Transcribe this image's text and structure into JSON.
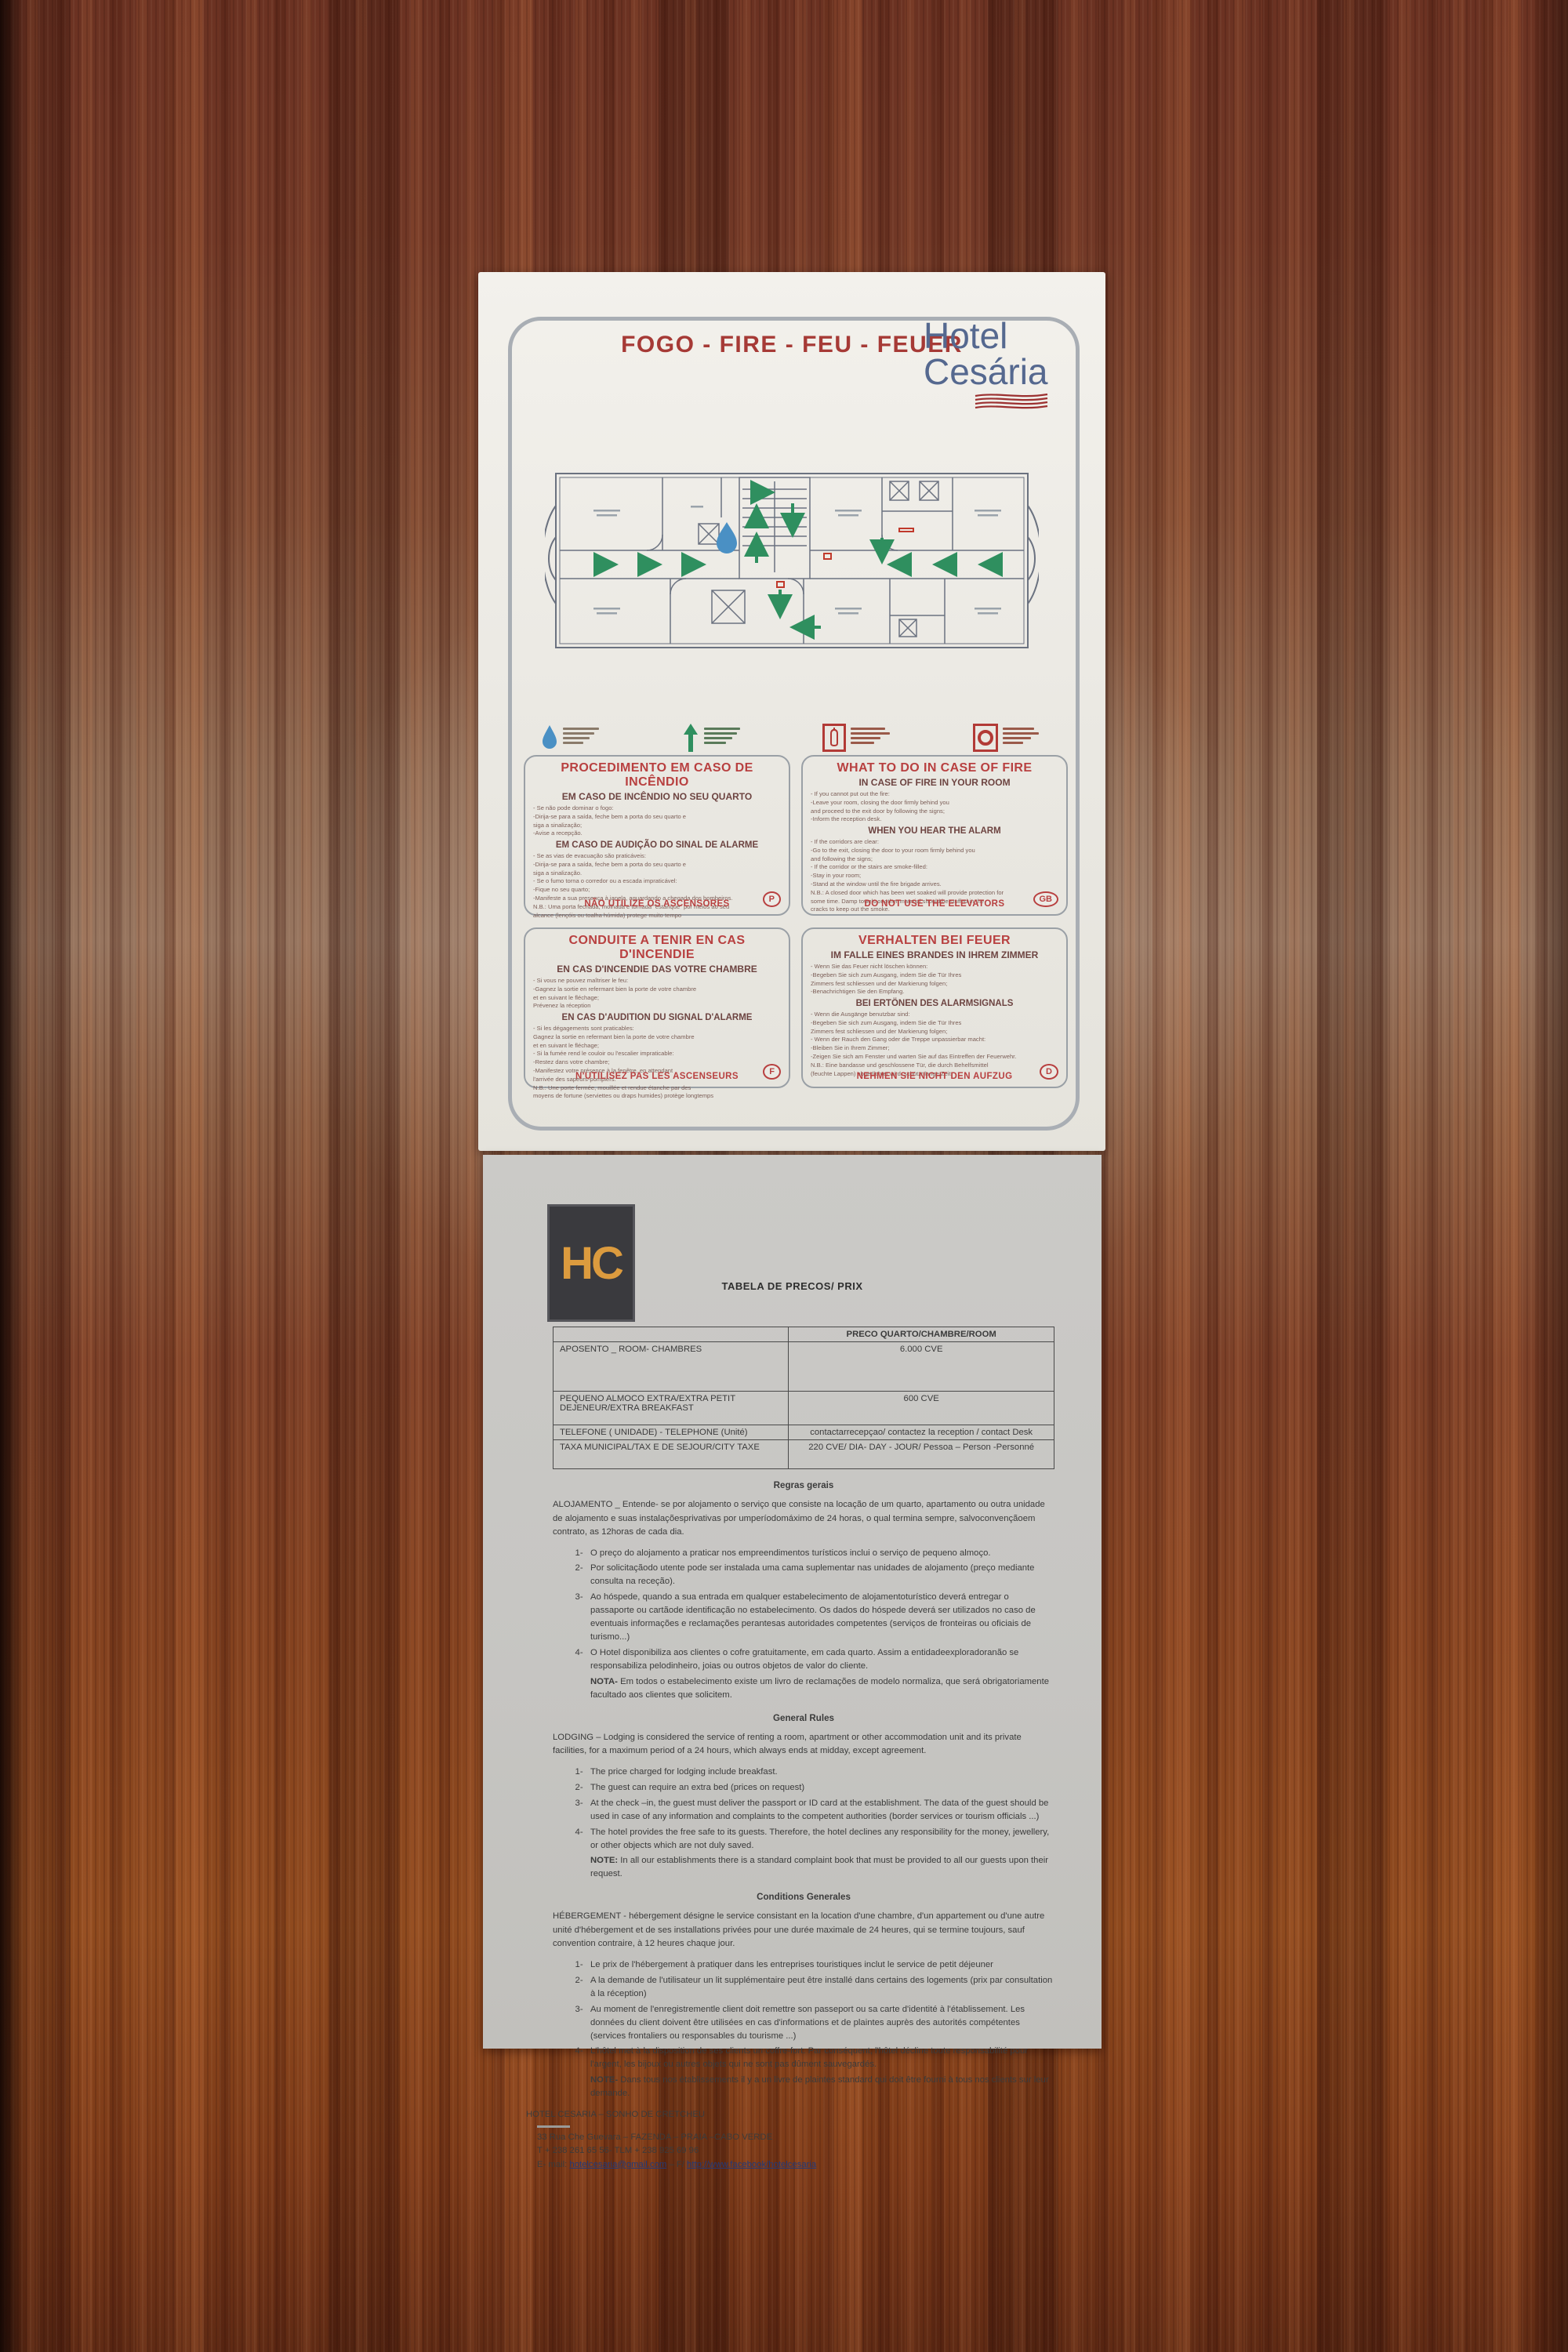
{
  "colors": {
    "wood_base": "#7b3f27",
    "sheet_white": "#f0eee9",
    "sheet_gray": "#c7c6c3",
    "title_red": "#a63a36",
    "notice_red": "#b84040",
    "subtitle_maroon": "#6d4441",
    "brand_blue": "#55688f",
    "wave_red": "#9c3030",
    "arrow_green": "#2f8f5f",
    "droplet_blue": "#4a90c4",
    "hc_orange": "#dc9b3e",
    "link_blue": "#223a7a"
  },
  "fire_notice": {
    "title": "FOGO - FIRE - FEU - FEUER",
    "brand": {
      "line1": "Hotel",
      "line2": "Cesária"
    },
    "legend_icons": [
      "you-are-here-droplet",
      "evacuation-route-arrow",
      "fire-extinguisher",
      "fire-hose-reel"
    ],
    "boxes": {
      "pt": {
        "title": "PROCEDIMENTO EM CASO DE INCÊNDIO",
        "subtitle": "EM CASO DE INCÊNDIO NO SEU QUARTO",
        "part1": [
          "- Se não pode dominar o fogo:",
          "-Dirija-se para a saída, feche  bem a porta do seu quarto  e",
          "siga a sinalização;",
          "-Avise a recepção."
        ],
        "heading2": "EM CASO DE AUDIÇÃO DO SINAL DE ALARME",
        "part2": [
          "- Se as vias de evacuação são praticáveis:",
          "-Dirija-se para a saída, feche  bem a porta do seu quarto  e",
          "siga a sinalização.",
          "- Se o fumo torna o corredor ou a escada impraticável:",
          "-Fique no seu quarto;",
          "-Manifeste a sua presença à janela, aguardando a chegada dos bombeiros.",
          "N.B.: Uma porta fechada, molhada e tornada \"estanque\" por meios ao seu",
          "alcance (lençóis ou toalha húmida) protege muito tempo"
        ],
        "warning": "NÃO UTILIZE OS ASCENSORES",
        "badge": "P"
      },
      "gb": {
        "title": "WHAT TO DO IN CASE OF FIRE",
        "subtitle": "IN CASE OF FIRE IN YOUR ROOM",
        "part1": [
          "- If you cannot put out the fire:",
          "-Leave your room, closing the door firmly behind you",
          "and proceed to the exit door by following the signs;",
          "-Inform the reception desk."
        ],
        "heading2": "WHEN YOU HEAR THE ALARM",
        "part2": [
          "- If the corridors are clear:",
          "-Go to the exit, closing the door to your room firmly behind you",
          "and following the signs;",
          "- If the corridor or the stairs are smoke-filled:",
          "-Stay in your room;",
          "-Stand at the window until the fire brigade arrives.",
          "N.B.: A closed door which has been wet soaked will provide protection for",
          "some time. Damp towels or other material should be stuffed in the",
          "cracks to keep out the smoke."
        ],
        "warning": "DO NOT USE THE ELEVATORS",
        "badge": "GB"
      },
      "fr": {
        "title": "CONDUITE A TENIR EN CAS D'INCENDIE",
        "subtitle": "EN CAS D'INCENDIE DAS VOTRE CHAMBRE",
        "part1": [
          "- Si vous ne pouvez maîtriser le feu:",
          "-Gagnez la sortie en refermant bien la porte de votre chambre",
          "et en suivant le fléchage;",
          "Prévenez la réception"
        ],
        "heading2": "EN CAS D'AUDITION DU SIGNAL D'ALARME",
        "part2": [
          "- Si les dégagements sont praticables:",
          "Gagnez la sortie en refermant bien la porte de votre chambre",
          "et en suivant le fléchage;",
          "- Si la fumée rend le couloir ou l'escalier impraticable:",
          "-Restez dans votre chambre;",
          "-Manifestez votre présence à la fenêtre, en attendant",
          "l'arrivée des sapeurs-pompiers.",
          "N.B.: Une porte fermée, mouillée et rendue étanche par des",
          "moyens de fortune (serviettes ou draps humides) protège longtemps"
        ],
        "warning": "N'UTILISEZ PAS LES ASCENSEURS",
        "badge": "F"
      },
      "de": {
        "title": "VERHALTEN BEI FEUER",
        "subtitle": "IM FALLE EINES BRANDES IN IHREM ZIMMER",
        "part1": [
          "- Wenn Sie das Feuer nicht löschen können:",
          "-Begeben Sie sich zum Ausgang, indem Sie die Tür Ihres",
          "Zimmers fest schliessen und der Markierung folgen;",
          "-Benachrichtigen Sie den Empfang."
        ],
        "heading2": "BEI ERTÖNEN DES ALARMSIGNALS",
        "part2": [
          "- Wenn die Ausgänge benutzbar sind:",
          "-Begeben Sie sich zum Ausgang, indem Sie die Tür Ihres",
          "Zimmers fest schliessen und der Markierung folgen;",
          "- Wenn der Rauch den Gang oder die Treppe unpassierbar macht:",
          "-Bleiben Sie in Ihrem Zimmer;",
          "-Zeigen Sie sich am Fenster und warten Sie auf das Eintreffen der Feuerwehr.",
          "N.B.: Eine bandasse und geschlossene Tür, die durch Behelfsmittel",
          "(feuchte Lappen) abgedichtet wird, schützt lange Zeit."
        ],
        "warning": "NEHMEN SIE NICHT DEN AUFZUG",
        "badge": "D"
      }
    }
  },
  "price_sheet": {
    "logo": "HC",
    "title": "TABELA DE PRECOS/ PRIX",
    "table": {
      "header_right": "PRECO QUARTO/CHAMBRE/ROOM",
      "rows": [
        {
          "label": "APOSENTO _ ROOM- CHAMBRES",
          "value": "6.000 CVE"
        },
        {
          "label": "PEQUENO ALMOCO EXTRA/EXTRA PETIT DEJENEUR/EXTRA BREAKFAST",
          "value": "600 CVE"
        },
        {
          "label": "TELEFONE ( UNIDADE) - TELEPHONE (Unité)",
          "value": "contactarrecepçao/ contactez la reception / contact Desk"
        },
        {
          "label": "TAXA MUNICIPAL/TAX E DE SEJOUR/CITY TAXE",
          "value": "220 CVE/ DIA- DAY - JOUR/ Pessoa – Person -Personné"
        }
      ]
    },
    "rules_pt": {
      "heading": "Regras gerais",
      "intro": "ALOJAMENTO _ Entende- se por alojamento o serviço que consiste na locação de um quarto, apartamento ou outra unidade de alojamento e suas instalaçõesprivativas por umperíodomáximo de 24 horas, o qual termina sempre, salvoconvençãoem contrato, as 12horas de cada dia.",
      "items": [
        "O preço do alojamento a praticar nos empreendimentos turísticos inclui o serviço de pequeno almoço.",
        "Por solicitaçãodo utente pode ser instalada uma cama suplementar nas unidades de alojamento (preço mediante consulta na receção).",
        "Ao hóspede, quando a sua entrada em qualquer estabelecimento de alojamentoturístico deverá entregar o passaporte ou cartãode identificação no estabelecimento. Os dados do hóspede deverá ser utilizados no caso de eventuais informações e reclamações perantesas autoridades competentes (serviços de fronteiras ou oficiais de turismo...)",
        "O Hotel disponibiliza aos clientes o cofre gratuitamente, em cada quarto. Assim a entidadeexploradoranão se responsabiliza pelodinheiro, joias ou outros objetos de valor do cliente."
      ],
      "note_label": "NOTA-",
      "note": " Em todos o estabelecimento existe um livro de reclamações de modelo normaliza, que será obrigatoriamente facultado aos clientes que solicitem."
    },
    "rules_en": {
      "heading": "General Rules",
      "intro": "LODGING – Lodging is considered the service of renting a room, apartment or other accommodation unit and its private facilities, for a maximum period of a 24 hours, which always ends at midday, except agreement.",
      "items": [
        "The price charged for lodging include breakfast.",
        "The guest can require an extra bed (prices on request)",
        "At the check –in, the guest must deliver the passport or ID card at the establishment. The data of the guest should be used in case of any information and complaints to the competent authorities (border services or tourism officials ...)",
        "The hotel provides the free safe to its guests. Therefore, the hotel declines any responsibility for the money, jewellery, or other objects which are not duly saved."
      ],
      "note_label": "NOTE:",
      "note": " In all our establishments there is a standard complaint book that must be provided to all our guests upon their request."
    },
    "rules_fr": {
      "heading": "Conditions Generales",
      "intro": "HÉBERGEMENT - hébergement désigne le service consistant en la location d'une chambre, d'un appartement ou d'une autre unité d'hébergement et de ses installations privées pour une durée maximale de 24 heures, qui se termine toujours, sauf convention contraire, à 12 heures chaque jour.",
      "items": [
        "Le prix de l'hébergement à pratiquer dans les entreprises touristiques inclut le service de petit déjeuner",
        "A la demande de l'utilisateur un lit supplémentaire peut être installé dans certains des logements (prix par consultation à la réception)",
        "Au moment de l'enregistrementle client doit remettre son passeport ou sa carte d'identité à l'établissement. Les données du client doivent être utilisées en cas d'informations et de plaintes auprès des autorités compétentes (services frontaliers ou responsables du tourisme ...)",
        "L'hôtel met à la disposition de ses clients un coffre-fort. Par conséquent, l'hôtel décline toute responsabilité pour l'argent, les bijoux ou autres objets qui ne sont pas dûment sauvegardés."
      ],
      "note_label": "NOTE-",
      "note": " Dans tous nos établissements il y a un livre de plaintes standard qui doit être fourni à tous nos clients sur leur demande."
    },
    "footer": {
      "hotel_line": "HOTEL CESARIA – SONHO DE CRETCHEU",
      "address": "33 Rua Che Guevara – FAZENDA – PRAIA –CABO VERDE",
      "phone": "T + 238 261 65 56- TLM + 238 925 69 96",
      "email_prefix": "E- mail:",
      "email_link": "hotelcesaria@gmail.com",
      "between_links": " – F/",
      "facebook_link": "http://www.facebook/hotelcesaria"
    }
  }
}
